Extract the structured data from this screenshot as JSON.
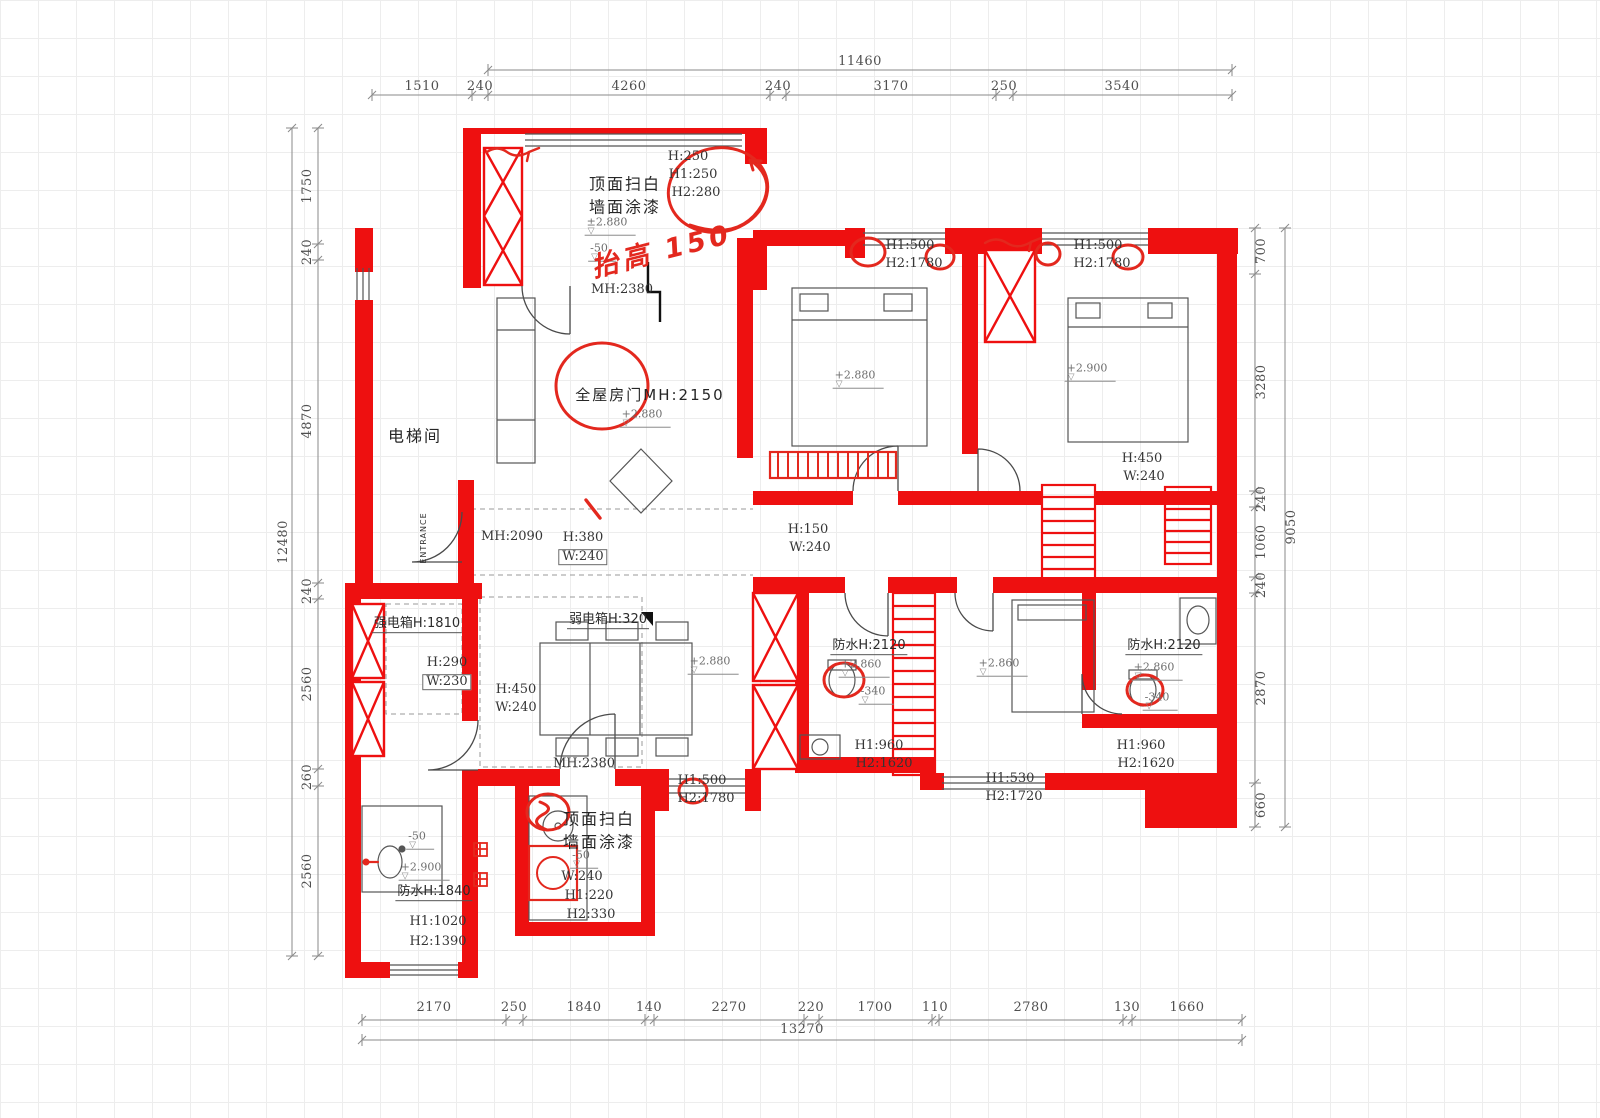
{
  "colors": {
    "wall_red": "#ee1010",
    "markup_red": "#e3281e",
    "line_dark": "#4a4a4a",
    "dim_gray": "#4f4f4f",
    "grid_gray": "#ededed"
  },
  "dims": {
    "top": {
      "overall": "11460",
      "segs": [
        "1510",
        "240",
        "4260",
        "240",
        "3170",
        "250",
        "3540"
      ]
    },
    "bottom": {
      "overall": "13270",
      "segs": [
        "2170",
        "250",
        "1840",
        "140",
        "2270",
        "220",
        "1700",
        "110",
        "2780",
        "130",
        "1660"
      ]
    },
    "left": {
      "overall": "12480",
      "segs": [
        "1750",
        "240",
        "4870",
        "240",
        "2560",
        "260",
        "2560"
      ]
    },
    "right": {
      "overall": "9050",
      "segs": [
        "700",
        "3280",
        "240",
        "1060",
        "240",
        "2870",
        "660"
      ]
    }
  },
  "rooms": {
    "elevator": "电梯间",
    "entrance": "ENTRANCE"
  },
  "notes": {
    "paint_top": [
      "顶面扫白",
      "墙面涂漆"
    ],
    "paint_bottom": [
      "顶面扫白",
      "墙面涂漆"
    ],
    "whole_house_door": "全屋房门MH:2150",
    "handwritten": "抬高 150",
    "strong_box": "强电箱H:1810",
    "weak_box": "弱电箱H:320",
    "waterproof_mid": "防水H:2120",
    "waterproof_right": "防水H:2120",
    "waterproof_bottom": "防水H:1840"
  },
  "openings": {
    "door_top": "MH:2380",
    "door_mid": "MH:2090",
    "door_bottom": "MH:2380",
    "win_top": [
      "H:250",
      "H1:250",
      "H2:280"
    ],
    "win_bed1": [
      "H1:500",
      "H2:1780"
    ],
    "win_bed2": [
      "H1:500",
      "H2:1780"
    ],
    "pass_living": [
      "H:380",
      "W:240"
    ],
    "pass_corridor": [
      "H:150",
      "W:240"
    ],
    "pass_right": [
      "H:450",
      "W:240"
    ],
    "pass_dining": [
      "H:450",
      "W:240"
    ],
    "niche": [
      "H:290",
      "W:230"
    ],
    "win_bath_mid": [
      "H1:960",
      "H2:1620"
    ],
    "win_bath_right": [
      "H1:960",
      "H2:1620"
    ],
    "win_bed3": [
      "H1:530",
      "H2:1720"
    ],
    "win_balcony": [
      "H1:500",
      "H2:1780"
    ],
    "win_kitchen": [
      "W:240",
      "H1:220",
      "H2:330"
    ],
    "win_bath_bottom": [
      "H1:1020",
      "H2:1390"
    ]
  },
  "levels": {
    "top_pm2880": "±2.880",
    "top_m50": "-50",
    "door_p2880": "+2.880",
    "bed1_p2880": "+2.880",
    "bed2_p2900": "+2.900",
    "hall_p2880": "+2.880",
    "mid_p2860": "+2.860",
    "mid_m340": "-340",
    "right_p2860": "+2.860",
    "right_m340": "-340",
    "bed3_p2860": "+2.860",
    "kitchen_m50": "-50",
    "bath_bottom_m50": "-50",
    "bath_bottom_p2900": "+2.900"
  }
}
